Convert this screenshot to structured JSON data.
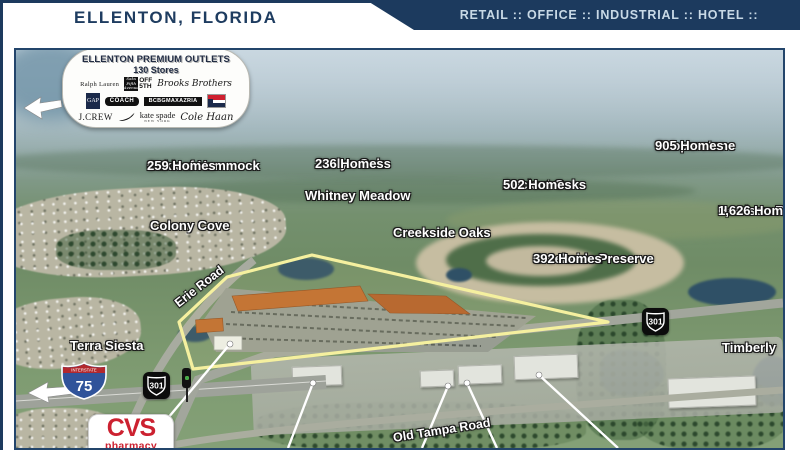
{
  "header": {
    "title": "ELLENTON, FLORIDA",
    "categories": "RETAIL :: OFFICE :: INDUSTRIAL :: HOTEL :: RESIDENTIAL"
  },
  "outlets": {
    "title": "ELLENTON PREMIUM OUTLETS",
    "stores": "130 Stores",
    "brands": {
      "ralph": "Ralph Lauren",
      "saks_script": "Saks Fifth Avenue",
      "saks_off_line1": "OFF",
      "saks_off_line2": "5TH",
      "brooks": "Brooks Brothers",
      "gap": "GAP",
      "coach": "COACH",
      "bcbg": "BCBGMAXAZRIA",
      "tommy": "Tommy Hilfiger",
      "jcrew": "J.CREW",
      "nike": "Nike",
      "kate": "kate spade",
      "kate_sub": "NEW YORK",
      "cole": "Cole Haan"
    }
  },
  "communities": {
    "oakleaf": {
      "name": "Oakleaf Hammock",
      "homes": "259 Homes"
    },
    "jaclyn": {
      "name": "Jaclyn Oaks",
      "homes": "236 Homes"
    },
    "whitney": {
      "name": "Whitney Meadow"
    },
    "ancient": {
      "name": "Ancient Oaks",
      "homes": "502 Homes"
    },
    "cooperstone": {
      "name": "Cooperstone",
      "homes": "905 Homes"
    },
    "harrison": {
      "name": "Harrison Ranch",
      "homes": "1,626 Homes"
    },
    "colony": {
      "name": "Colony Cove"
    },
    "creekside_oaks": {
      "name": "Creekside Oaks"
    },
    "creekside_preserve": {
      "name": "Creekside Preserve",
      "homes": "392 Homes"
    },
    "terra": {
      "name": "Terra Siesta"
    },
    "timberly": {
      "name": "Timberly"
    }
  },
  "roads": {
    "erie": "Erie Road",
    "old_tampa": "Old Tampa Road"
  },
  "shields": {
    "i75_top": "INTERSTATE",
    "i75": "75",
    "us301": "301"
  },
  "cvs": {
    "name": "CVS",
    "tagline": "pharmacy"
  },
  "colors": {
    "navy": "#1c3a5e",
    "outline_yellow": "#f5f09f",
    "cvs_red": "#cc2130"
  }
}
